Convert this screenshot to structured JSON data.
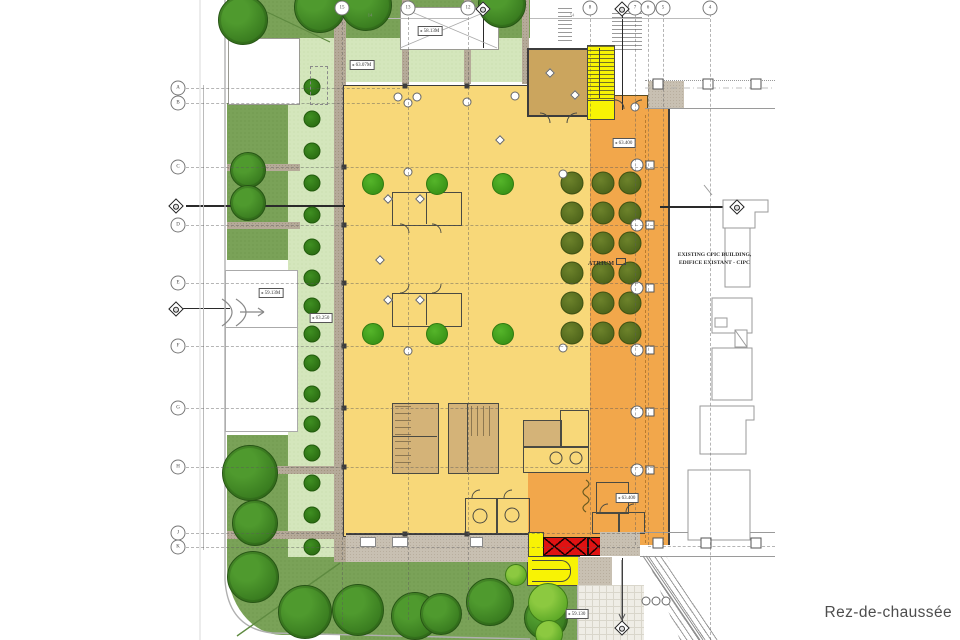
{
  "caption": "Rez-de-chaussée",
  "labels": {
    "atrium": "ATRIUM",
    "existing_building_line1": "EXISTING CPIC BUILDING,",
    "existing_building_line2": "EDIFICE EXISTANT - CIPC"
  },
  "levels": {
    "l1": "58.13M",
    "l2": "63.07M",
    "l3": "59.13M",
    "l4": "63.250",
    "l5": "63.400",
    "l6": "63.400",
    "l7": "59.130"
  },
  "grid": {
    "left": [
      "A",
      "B",
      "C",
      "D",
      "E",
      "F",
      "G",
      "H",
      "J",
      "K"
    ],
    "top": [
      "15",
      "13",
      "12",
      "8",
      "7",
      "6",
      "5",
      "4"
    ]
  },
  "dimensions": [
    "14",
    "54"
  ],
  "colors": {
    "lawn_green": "#7aa258",
    "light_green": "#d4e6bc",
    "floor_yellow": "#f8d879",
    "atrium_orange": "#f2a74b",
    "highlight_yellow": "#f8f304",
    "escalator_red": "#e01212",
    "room_tan": "#cba55e"
  }
}
